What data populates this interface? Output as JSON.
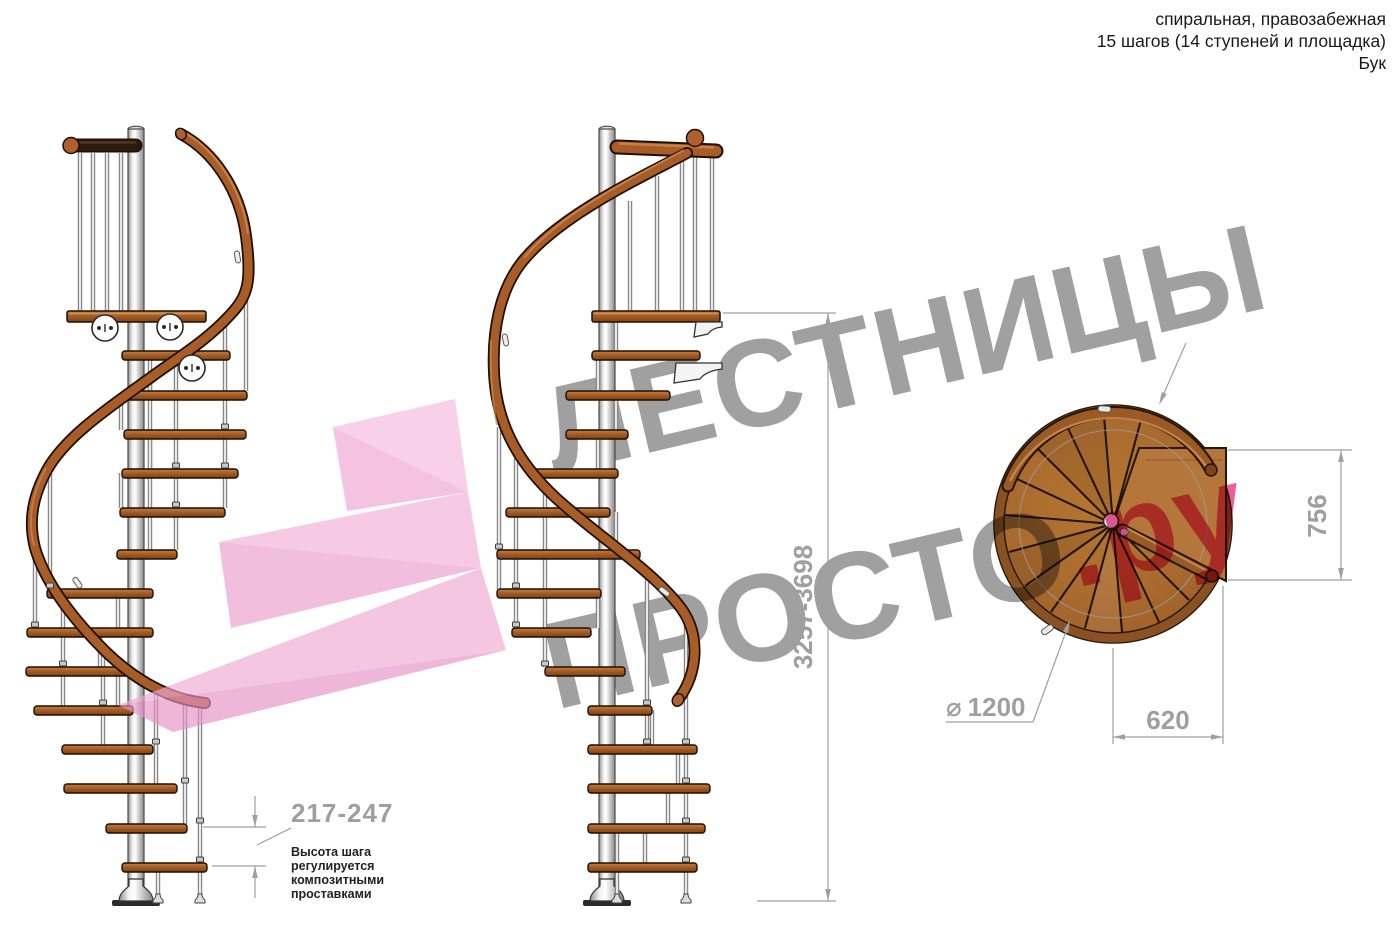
{
  "header": {
    "line1": "спиральная, правозабежная",
    "line2": "15 шагов (14 ступеней и площадка)",
    "line3": "Бук"
  },
  "watermark": {
    "line1": "ЛЕСТНИЦЫ",
    "line2_gray": "ПРОСТО",
    "line2_pink": ".ру"
  },
  "dimensions": {
    "total_height": "3257-3698",
    "landing_depth": "756",
    "landing_width": "620",
    "diameter_symbol": "⌀",
    "diameter_value": "1200",
    "step_pitch": "217-247",
    "note_lines": [
      "Высота шага",
      "регулируется",
      "композитными",
      "проставками"
    ]
  },
  "colors": {
    "dimension_gray": "#9f9f9f",
    "watermark_gray": "#a0a0a0",
    "watermark_pink": "#ec5f9d",
    "ribbon_pink": "#f0a9d4",
    "wood_mid": "#a85c28",
    "wood_dark": "#6e3a14",
    "dark_rail": "#2e1a0c",
    "note_text": "#222222"
  }
}
